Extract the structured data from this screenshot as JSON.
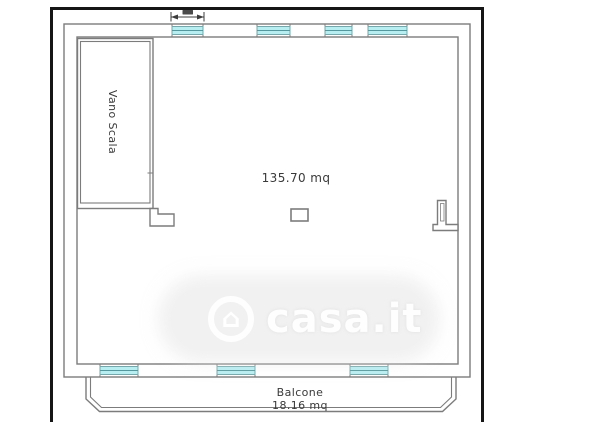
{
  "plan": {
    "stairwell_label": "Vano Scala",
    "main_room_area": "135.70 mq",
    "balcony_label": "Balcone",
    "balcony_area": "18.16 mq"
  },
  "watermark": {
    "text": "casa.it",
    "logo_icon": "house-icon",
    "house_glyph": "⌂"
  },
  "colors": {
    "frame": "#161616",
    "wall_line": "#7c7c7c",
    "window_fill": "#b7eef2",
    "window_border": "#76a8ab",
    "label_text": "#3a3a3a",
    "watermark_text": "#ffffff"
  }
}
